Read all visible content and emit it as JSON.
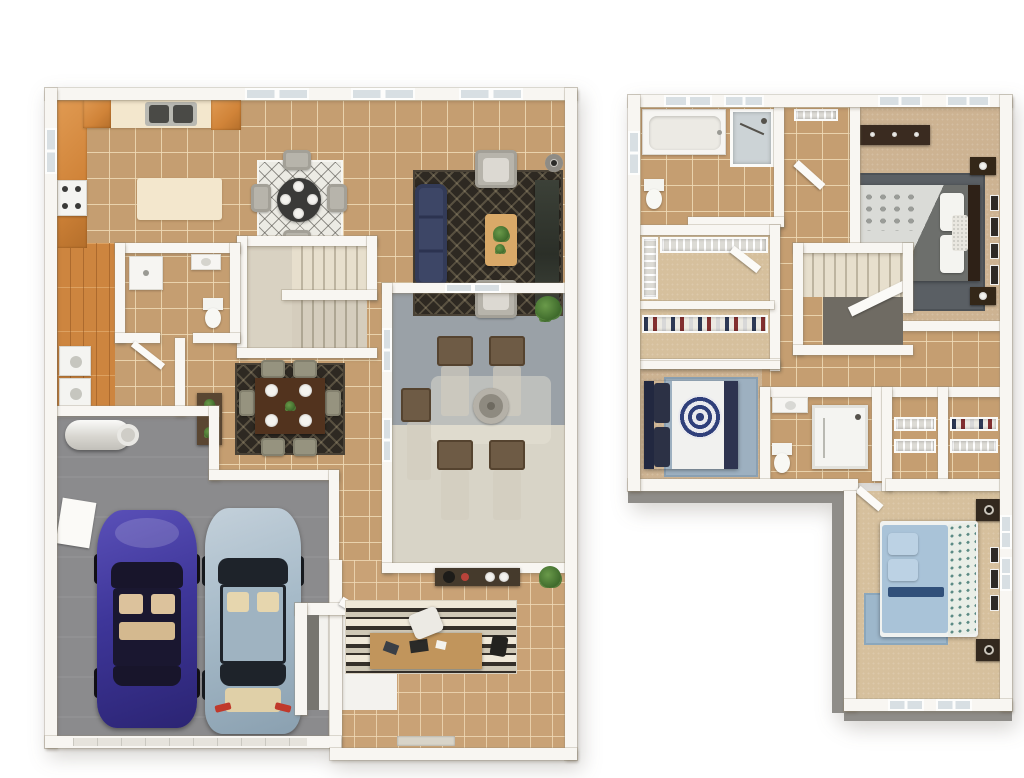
{
  "scene": {
    "type": "3d-floor-plan-rendering",
    "description": "Top-down 3D dollhouse rendering of a two-story home: first floor on the left, second floor on the right, on a white background. No visible text labels.",
    "background_color": "#ffffff",
    "floors": [
      {
        "name": "First Floor",
        "rooms": [
          {
            "id": "kitchen",
            "label": "Kitchen"
          },
          {
            "id": "breakfast-nook",
            "label": "Breakfast Nook"
          },
          {
            "id": "living-room",
            "label": "Living Room"
          },
          {
            "id": "staircase",
            "label": "Staircase"
          },
          {
            "id": "powder-room",
            "label": "Powder Room"
          },
          {
            "id": "laundry-room",
            "label": "Laundry Room"
          },
          {
            "id": "hallway",
            "label": "Wood-Floor Hallway"
          },
          {
            "id": "dining-area",
            "label": "Dining Area"
          },
          {
            "id": "garage",
            "label": "Two-Car Garage"
          },
          {
            "id": "patio",
            "label": "Covered Patio / Courtyard"
          },
          {
            "id": "office",
            "label": "Office / Den"
          },
          {
            "id": "entry",
            "label": "Entry"
          }
        ],
        "furniture": [
          "L-shaped orange-wood kitchen cabinets with double sink and range",
          "cream kitchen island",
          "round breakfast table with 4 chairs on white diamond rug",
          "navy sofa",
          "2 gray armchairs",
          "wood coffee table with plant",
          "dark media console",
          "floor lamp",
          "dark wood dining table with 6 chairs and place settings on dark rug",
          "console table with plants",
          "stacked laundry machines",
          "water heater",
          "electrical panel",
          "purple sedan",
          "silver-blue sedan",
          "4 wicker patio chairs with pale loungers",
          "round fire pit",
          "side patio chair",
          "potted patio plant",
          "entry console with decor",
          "desk with chair on striped rug",
          "corner plant"
        ]
      },
      {
        "name": "Second Floor",
        "rooms": [
          {
            "id": "master-bathroom",
            "label": "Master Bathroom"
          },
          {
            "id": "bath-hall",
            "label": "Bath Hall / Water Closet"
          },
          {
            "id": "master-bedroom",
            "label": "Master Bedroom"
          },
          {
            "id": "walk-in-closet",
            "label": "Walk-in Closet"
          },
          {
            "id": "second-closet",
            "label": "Second Closet"
          },
          {
            "id": "stairwell",
            "label": "Stairwell"
          },
          {
            "id": "bedroom-2",
            "label": "Bedroom 2"
          },
          {
            "id": "bathroom-2",
            "label": "Bathroom 2"
          },
          {
            "id": "linen-closets",
            "label": "Linen Closets"
          },
          {
            "id": "upstairs-hallway",
            "label": "Upstairs Hallway"
          },
          {
            "id": "bedroom-3",
            "label": "Bedroom 3"
          }
        ],
        "furniture": [
          "garden tub",
          "glass shower",
          "toilet",
          "towel rack",
          "wire closet shelving with hanging clothes",
          "dark wood master bed with gray and white floral bedding",
          "dark dresser and nightstand",
          "wall art frames",
          "gray area rug",
          "navy and white bed with round navy medallion duvet",
          "blue area rug",
          "shower stall",
          "vanity with sink",
          "light blue bed with teal floral throw",
          "dark nightstands with lamps"
        ]
      }
    ],
    "palette": {
      "background": "#ffffff",
      "wall": "#f8f6f2",
      "exterior_wall_face": "#8f8d89",
      "tile_floor": "#c59e71",
      "tile_grout": "#f0dbb6",
      "wood_floor": "#cd853f",
      "carpet": "#cdb392",
      "garage_floor": "#8b8b8d",
      "patio_floor_dark": "#9aa1a7",
      "patio_floor_light": "#d8d4c7",
      "cabinet_wood": "#d08338",
      "countertop": "#f3e7cd",
      "sofa_navy": "#3d4666",
      "dark_rug": "#2e2922",
      "car_purple": "#3e3699",
      "car_blue": "#a7bbc9",
      "bed_light_blue": "#a9c3d8",
      "bed_navy": "#2c3145",
      "plant_green": "#4d7a3a"
    }
  }
}
